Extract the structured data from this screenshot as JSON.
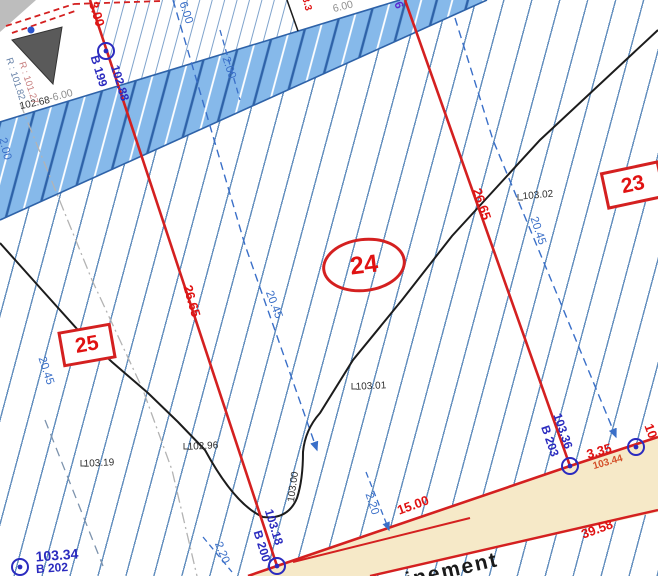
{
  "map": {
    "parcels": {
      "p23": "23",
      "p24": "24",
      "p25": "25"
    },
    "red_dimensions": {
      "d3_00": "3.00",
      "d26_65_left": "26.65",
      "d26_65_right": "26.65",
      "d15_00": "15.00",
      "d3_35": "3.35",
      "d39_58": "39.58",
      "d103_44": "103.44",
      "d10_partial": "10",
      "d3_3_partial": "3.3"
    },
    "survey_points": {
      "b199_name": "B 199",
      "b199_elev": "102.88",
      "b200_name": "B 200",
      "b200_elev": "103.18",
      "b202_name": "B 202",
      "b202_elev": "103.34",
      "b203_name": "B 203",
      "b203_elev": "103.36"
    },
    "blue_dimensions": {
      "d20_45_mid": "20.45",
      "d20_45_left": "20.45",
      "d20_45_right": "20.45",
      "d2_20_left": "2.20",
      "d2_20_right": "2.20",
      "d2_00_top": "2.00",
      "d2_00_edge": "2.00",
      "d6_00_blue": "6.00"
    },
    "spot_heights": {
      "s102_68": "102.68",
      "s103_02": "103.02",
      "s103_01": "103.01",
      "s102_96": "102.96",
      "s103_19": "103.19",
      "contour_103_00": "103.00"
    },
    "gray_texts": {
      "minus6": "-6.00",
      "g6_00": "6.00"
    },
    "invert_levels": {
      "r1": "R : 101.82",
      "r2": "R : 101.27"
    },
    "road_label_partial": "inement",
    "purple_fragment": "6",
    "colors": {
      "red_line": "#d42020",
      "indigo_label": "#2b2bbf",
      "dim_blue": "#3a6fc8",
      "hatch_blue": "#467ab2",
      "road_band_fill": "#86b9ea",
      "path_band_fill": "#f6e9c8"
    }
  }
}
